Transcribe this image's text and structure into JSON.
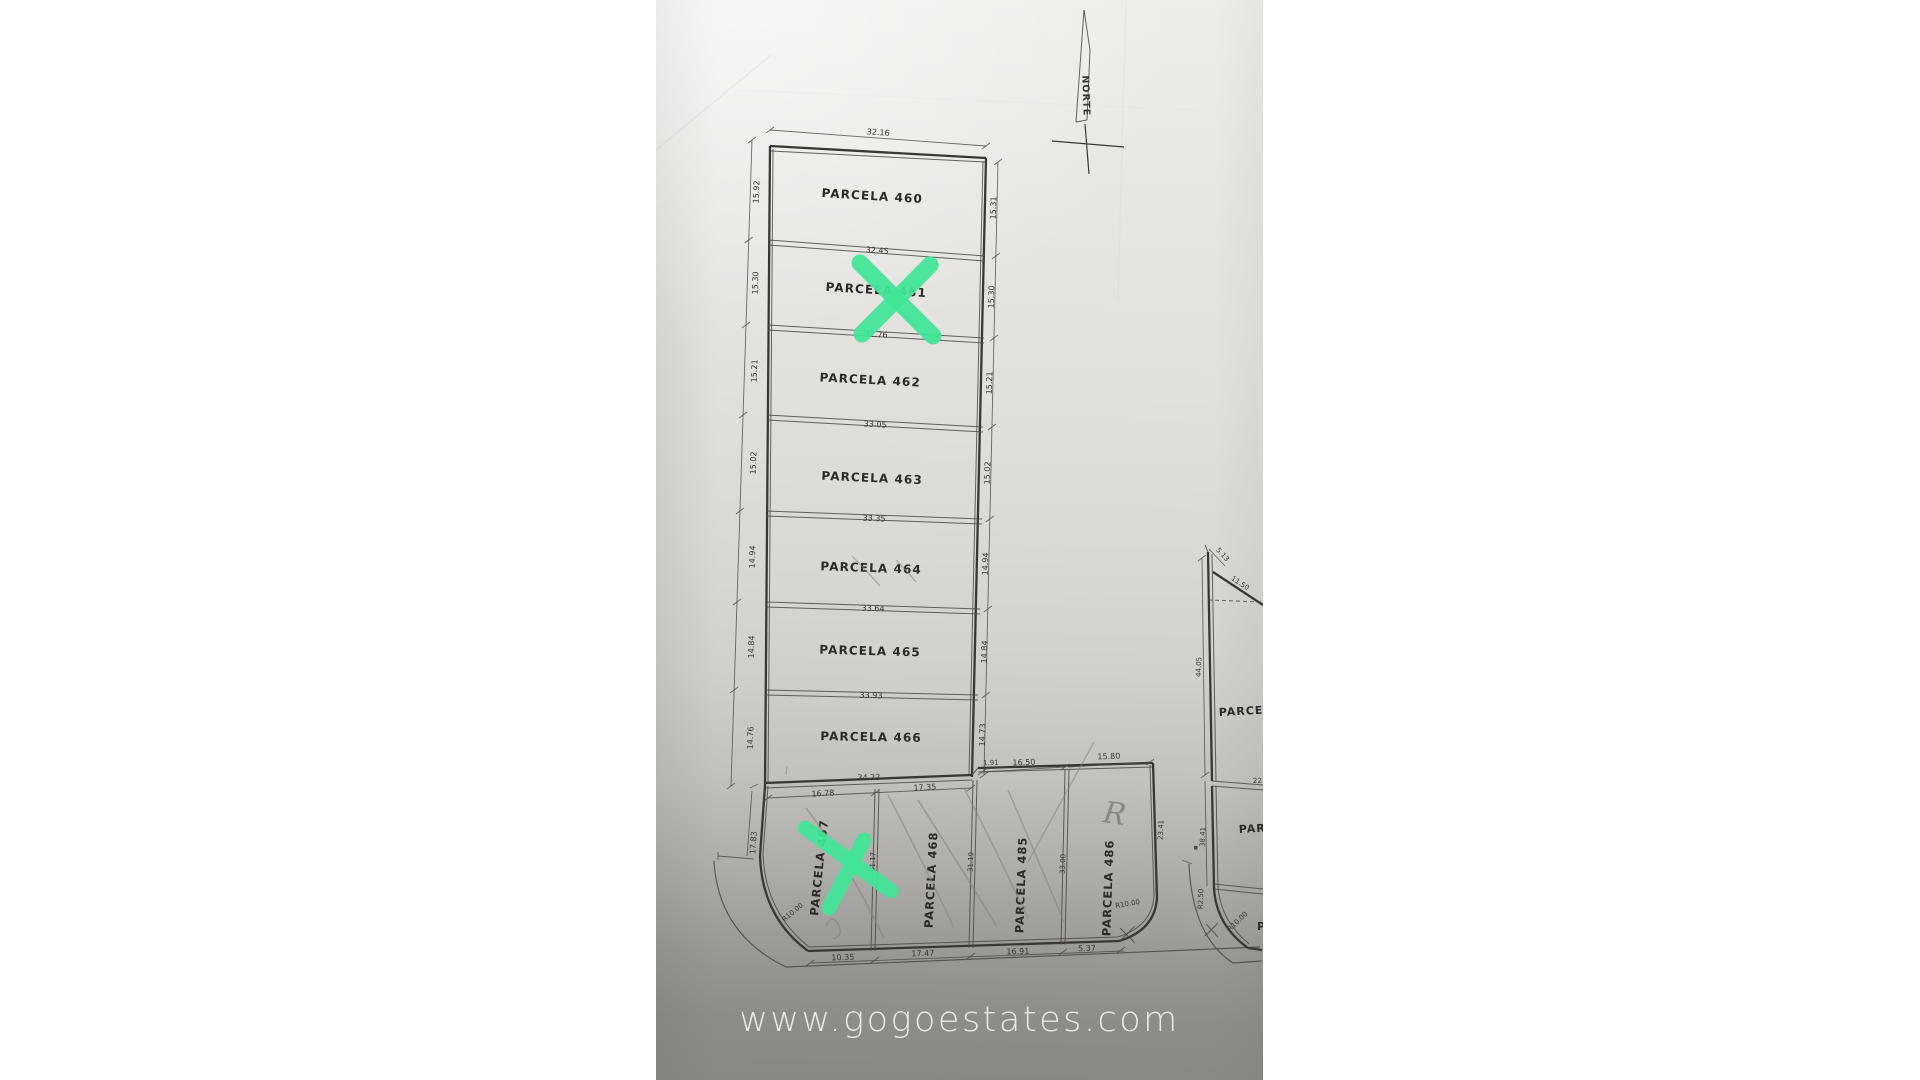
{
  "watermark": "www.gogoestates.com",
  "compass": {
    "label": "NORTE"
  },
  "colors": {
    "highlight_green": "#40e598",
    "ink": "#3a3733",
    "pencil": "#87847e",
    "paper_top": "#efede9",
    "paper_bottom": "#8a8884",
    "watermark_text": "#f3f0ec"
  },
  "main": {
    "parcels": [
      {
        "label": "PARCELA 460",
        "top": "32.16",
        "left": "15.92",
        "right": "15.31"
      },
      {
        "label": "PARCELA 461",
        "top": "32.45",
        "left": "15.30",
        "right": "15.30",
        "marked": "green-x"
      },
      {
        "label": "PARCELA 462",
        "top": "32.76",
        "left": "15.21",
        "right": "15.21"
      },
      {
        "label": "PARCELA 463",
        "top": "33.05",
        "left": "15.02",
        "right": "15.02"
      },
      {
        "label": "PARCELA 464",
        "top": "33.35",
        "left": "14.94",
        "right": "14.94"
      },
      {
        "label": "PARCELA 465",
        "top": "33.64",
        "left": "14.84",
        "right": "14.84"
      },
      {
        "label": "PARCELA 466",
        "top": "33.93",
        "left": "14.76",
        "right": "14.73",
        "bottom": "34.22"
      }
    ]
  },
  "row": {
    "top_dims": {
      "left_seg": "16.78",
      "right_seg": "17.35",
      "jog": "1.91",
      "p485": "16.50",
      "p486": "15.80"
    },
    "parcels": [
      {
        "label": "PARCELA 467",
        "left": "17.83",
        "corner": "R10.00",
        "bottom": "10.35",
        "right": "31.17",
        "marked": "green-x"
      },
      {
        "label": "PARCELA 468",
        "bottom": "17.47",
        "right": "31.19"
      },
      {
        "label": "PARCELA 485",
        "bottom": "16.91",
        "right": "33.00"
      },
      {
        "label": "PARCELA 486",
        "bottom": "5.37",
        "right": "23.41",
        "corner": "R10.00",
        "pencil_note": "R"
      }
    ]
  },
  "right_plan": {
    "top_dim": "5.13",
    "diagonal_dim": "11.50",
    "left_dim_upper": "44.05",
    "label_upper": "PARCEL",
    "divider_dim": "22",
    "left_dim_lower": "38.41",
    "label_lower": "PARC",
    "curve_dim": "R2.50",
    "corner": "R10.00",
    "label_cut": "P"
  }
}
